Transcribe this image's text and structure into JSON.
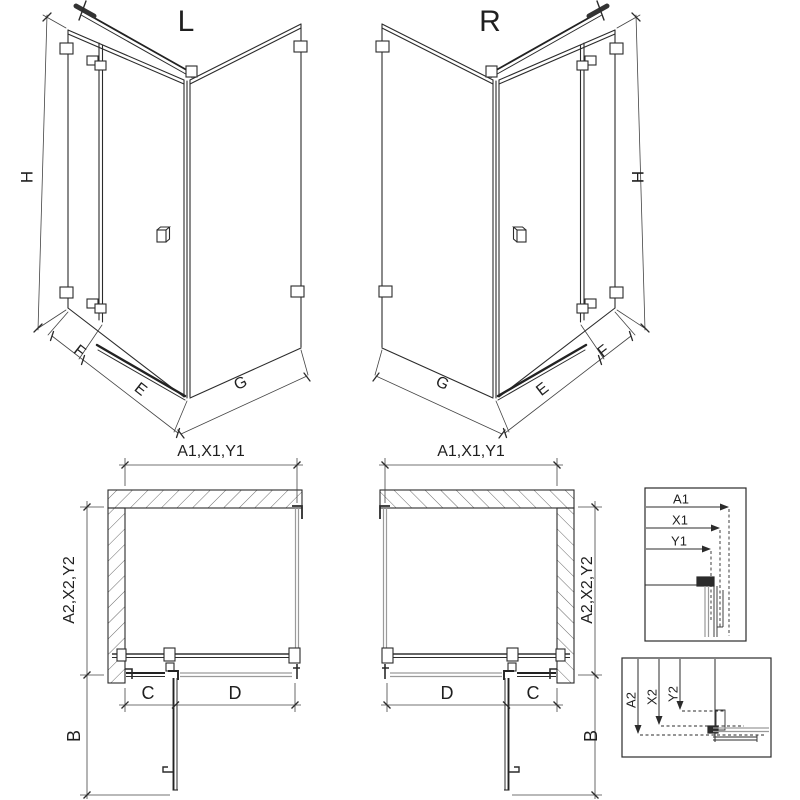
{
  "diagram": {
    "title_hint": "shower enclosure dimension drawing",
    "colors": {
      "line": "#2b2b2b",
      "glass": "#9a9a9a",
      "dim": "#444444",
      "background": "#ffffff"
    },
    "views": {
      "perspective_left": {
        "title": "L",
        "height": "H",
        "fixed_width": "F",
        "door_width": "E",
        "side_width": "G"
      },
      "perspective_right": {
        "title": "R",
        "height": "H",
        "fixed_width": "F",
        "door_width": "E",
        "side_width": "G"
      },
      "plan_left": {
        "width": "A1,X1,Y1",
        "depth": "A2,X2,Y2",
        "fixed": "C",
        "door": "D",
        "door_open_depth": "B"
      },
      "plan_right": {
        "width": "A1,X1,Y1",
        "depth": "A2,X2,Y2",
        "fixed": "C",
        "door": "D",
        "door_open_depth": "B"
      },
      "detail_width": {
        "a1": "A1",
        "x1": "X1",
        "y1": "Y1"
      },
      "detail_depth": {
        "a2": "A2",
        "x2": "X2",
        "y2": "Y2"
      }
    }
  }
}
